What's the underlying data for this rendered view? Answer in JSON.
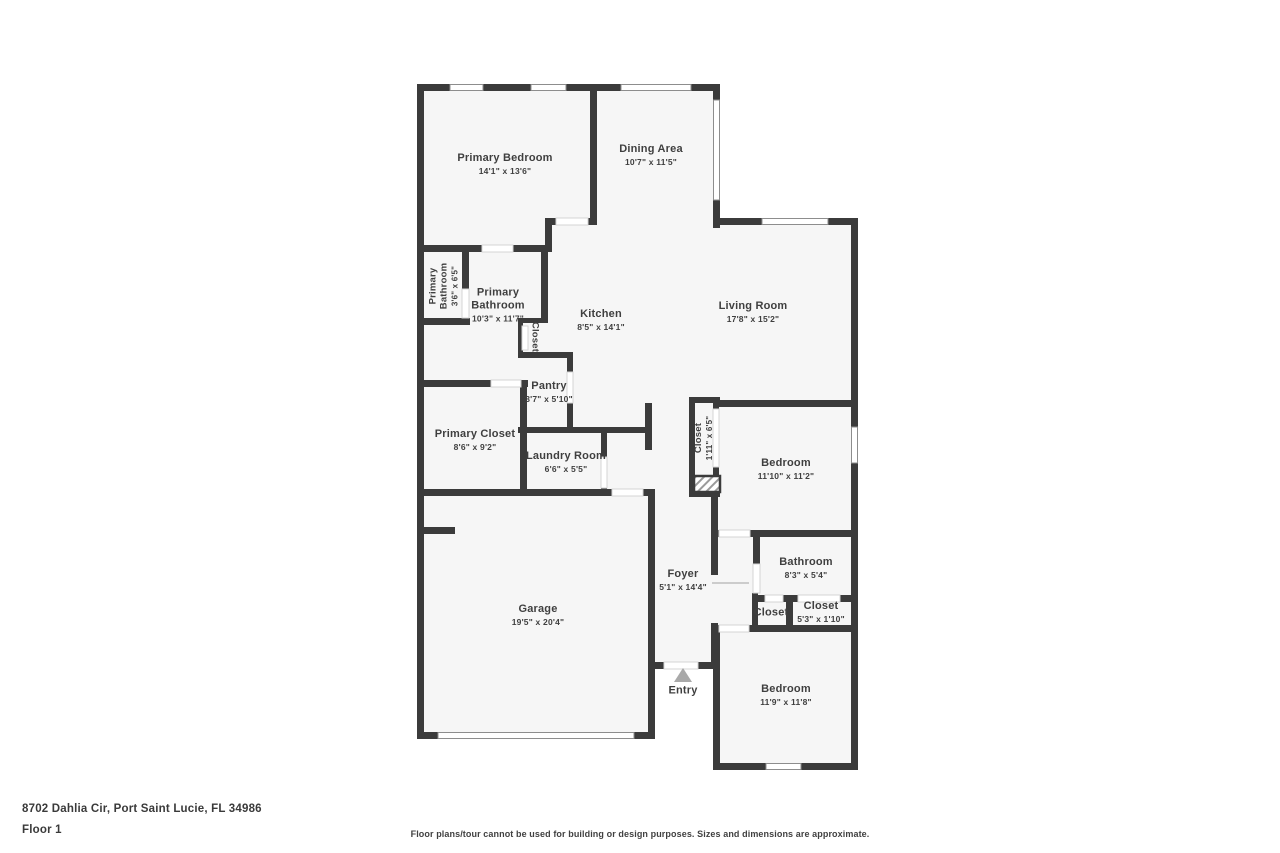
{
  "page": {
    "wall_color": "#3b3b3b",
    "floor_color": "#f6f6f6",
    "text_color": "#3f3f3f",
    "window_line_color": "#8d8d8d",
    "door_line_color": "#d4d4d4",
    "entry_arrow_color": "#a9a9a9"
  },
  "footer": {
    "address": "8702 Dahlia Cir, Port Saint Lucie, FL 34986",
    "floor_label": "Floor 1",
    "disclaimer": "Floor plans/tour cannot be used for building or design purposes. Sizes and dimensions are approximate."
  },
  "entry": {
    "label": "Entry",
    "x": 683,
    "y": 691
  },
  "rooms": [
    {
      "id": "primary-bedroom",
      "name": "Primary Bedroom",
      "dims": "14'1\" x 13'6\"",
      "x": 505,
      "y": 164
    },
    {
      "id": "dining-area",
      "name": "Dining Area",
      "dims": "10'7\" x 11'5\"",
      "x": 651,
      "y": 155
    },
    {
      "id": "primary-bathroom-toilet",
      "name": "Primary Bathroom",
      "dims": "3'6\" x 6'5\"",
      "x": 444,
      "y": 286,
      "rotate": -90,
      "w": 62,
      "small": true
    },
    {
      "id": "primary-bathroom",
      "name": "Primary Bathroom",
      "dims": "10'3\" x 11'7\"",
      "x": 498,
      "y": 305,
      "w": 72
    },
    {
      "id": "kitchen",
      "name": "Kitchen",
      "dims": "8'5\" x 14'1\"",
      "x": 601,
      "y": 320
    },
    {
      "id": "living-room",
      "name": "Living Room",
      "dims": "17'8\" x 15'2\"",
      "x": 753,
      "y": 312
    },
    {
      "id": "kitchen-closet",
      "name": "Closet",
      "dims": "",
      "x": 535,
      "y": 337,
      "rotate": 90,
      "small": true
    },
    {
      "id": "pantry",
      "name": "Pantry",
      "dims": "3'7\" x 5'10\"",
      "x": 549,
      "y": 392
    },
    {
      "id": "primary-closet",
      "name": "Primary Closet",
      "dims": "8'6\" x 9'2\"",
      "x": 475,
      "y": 440
    },
    {
      "id": "laundry-room",
      "name": "Laundry Room",
      "dims": "6'6\" x 5'5\"",
      "x": 566,
      "y": 462
    },
    {
      "id": "bedroom-closet",
      "name": "Closet",
      "dims": "1'11\" x 6'5\"",
      "x": 704,
      "y": 438,
      "rotate": -90,
      "small": true
    },
    {
      "id": "bedroom-1",
      "name": "Bedroom",
      "dims": "11'10\" x 11'2\"",
      "x": 786,
      "y": 469
    },
    {
      "id": "foyer",
      "name": "Foyer",
      "dims": "5'1\" x 14'4\"",
      "x": 683,
      "y": 580
    },
    {
      "id": "bathroom",
      "name": "Bathroom",
      "dims": "8'3\" x 5'4\"",
      "x": 806,
      "y": 568
    },
    {
      "id": "hall-closet",
      "name": "Closet",
      "dims": "",
      "x": 771,
      "y": 613
    },
    {
      "id": "hall-closet-2",
      "name": "Closet",
      "dims": "5'3\" x 1'10\"",
      "x": 821,
      "y": 612
    },
    {
      "id": "garage",
      "name": "Garage",
      "dims": "19'5\" x 20'4\"",
      "x": 538,
      "y": 615
    },
    {
      "id": "bedroom-2",
      "name": "Bedroom",
      "dims": "11'9\" x 11'8\"",
      "x": 786,
      "y": 695
    }
  ]
}
